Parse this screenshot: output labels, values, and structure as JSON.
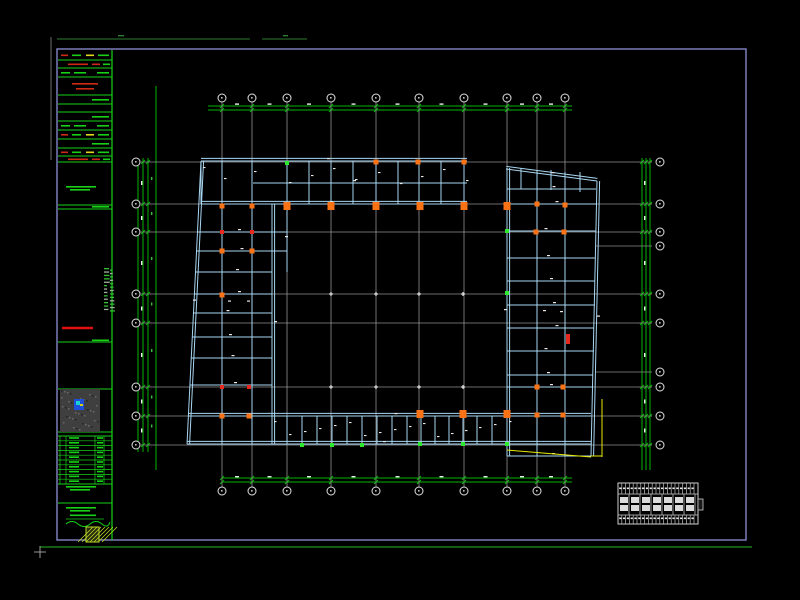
{
  "meta": {
    "app": "cad-viewer",
    "sheet_description": "structural-framing-plan-sheet",
    "canvas": {
      "w": 800,
      "h": 600
    }
  },
  "colors": {
    "bg": "#000000",
    "border_violet": "#8585c8",
    "strip_green": "#17d117",
    "dim_green": "#00b400",
    "faint_green": "#2e7d32",
    "grid_gray": "#9a9a9a",
    "bubble_stroke": "#e0e0e0",
    "beam_cyan": "#a9d7f2",
    "marker_orange": "#f97316",
    "marker_red": "#e8281e",
    "marker_green": "#2ee82e",
    "yellow": "#e8e800",
    "text_white": "#eaeaea",
    "red_text": "#cc2a14"
  },
  "frame": {
    "border": {
      "x1": 57,
      "y1": 49,
      "x2": 746,
      "y2": 540
    },
    "outer_vline": {
      "x": 51,
      "y1": 37,
      "y2": 160
    },
    "top_green_segs": [
      [
        57,
        39,
        250
      ],
      [
        262,
        39,
        307
      ]
    ],
    "top_green_dashes": [
      [
        118,
        35,
        6
      ],
      [
        283,
        35,
        5
      ]
    ],
    "bottom_green": {
      "y": 547,
      "x1": 40,
      "x2": 752
    },
    "ucs_cross": {
      "x": 40,
      "y": 552,
      "arm": 6
    }
  },
  "title_strip": {
    "x1": 58,
    "x2": 112,
    "y1": 50,
    "y2": 540,
    "dividers": [
      60,
      68,
      77,
      95,
      104,
      112,
      121,
      130,
      139,
      148,
      156,
      162,
      205,
      209,
      342,
      389,
      432,
      436,
      484,
      503,
      545
    ],
    "rows": [
      {
        "y": 51,
        "h": 9,
        "kind": "gr"
      },
      {
        "y": 61,
        "h": 7,
        "kind": "r"
      },
      {
        "y": 69,
        "h": 8,
        "kind": "g"
      },
      {
        "y": 78,
        "h": 17,
        "kind": "rb"
      },
      {
        "y": 96,
        "h": 8,
        "kind": "g2"
      },
      {
        "y": 105,
        "h": 7,
        "kind": "e"
      },
      {
        "y": 113,
        "h": 8,
        "kind": "g2"
      },
      {
        "y": 122,
        "h": 8,
        "kind": "g"
      },
      {
        "y": 131,
        "h": 8,
        "kind": "gr"
      },
      {
        "y": 140,
        "h": 8,
        "kind": "g2"
      },
      {
        "y": 149,
        "h": 7,
        "kind": "gr"
      },
      {
        "y": 157,
        "h": 5,
        "kind": "r"
      },
      {
        "y": 184,
        "h": 6,
        "kind": "gtext"
      },
      {
        "y": 205,
        "h": 4,
        "kind": "g2"
      },
      {
        "y": 338,
        "h": 5,
        "kind": "g2"
      },
      {
        "y": 484,
        "h": 6,
        "kind": "gtext"
      },
      {
        "y": 504,
        "h": 8,
        "kind": "gtext"
      },
      {
        "y": 512,
        "h": 7,
        "kind": "gu"
      },
      {
        "y": 519,
        "h": 8,
        "kind": "sig"
      }
    ],
    "red_line": {
      "x1": 62,
      "x2": 93,
      "y": 328
    },
    "map_thumb": {
      "x": 60,
      "y": 389,
      "w": 40,
      "h": 43,
      "dot": {
        "x": 74,
        "y": 399,
        "w": 10,
        "h": 11
      }
    },
    "mini_table": {
      "y1": 436,
      "y2": 484,
      "rows": 10,
      "col_xs": [
        60,
        66,
        95,
        104
      ]
    },
    "logo": {
      "x": 86,
      "y": 527,
      "w": 13,
      "h": 15
    },
    "side_text": {
      "cols": [
        {
          "x": 104,
          "w": 6
        },
        {
          "x": 110,
          "w": 5
        }
      ],
      "y1": 268,
      "y2": 312,
      "step": 3.4
    }
  },
  "grids": {
    "v_xs": [
      222,
      252,
      287,
      331,
      376,
      419,
      464,
      507,
      537,
      565
    ],
    "v_y1": 102,
    "v_y2": 487,
    "bubble_top_y": 98,
    "bubble_bot_y": 491,
    "h_ys": [
      162,
      204,
      232,
      294,
      323,
      387,
      416,
      445
    ],
    "h_x1": 141,
    "h_x2": 652,
    "bubble_left_x": 136,
    "bubble_right_x": 660,
    "h_stubs": [
      246,
      372
    ],
    "stub_x1": 596,
    "stub_x2": 652,
    "bubble_r": 4
  },
  "dims": {
    "top": {
      "ys": [
        106,
        110
      ],
      "x1": 208,
      "x2": 572
    },
    "bottom": {
      "ys": [
        478,
        482
      ],
      "x1": 222,
      "x2": 572
    },
    "left": {
      "xs": [
        138,
        143,
        148
      ],
      "y1": 158,
      "y2": 452,
      "extra_x": 156,
      "extra_y1": 86,
      "extra_y2": 470
    },
    "right": {
      "xs": [
        642,
        646,
        650
      ],
      "y1": 158,
      "y2": 470
    }
  },
  "beams": {
    "double": [
      [
        201,
        161,
        467,
        161
      ],
      [
        201,
        204,
        467,
        204
      ],
      [
        201,
        161,
        187,
        444
      ],
      [
        272,
        204,
        272,
        444
      ],
      [
        188,
        416,
        591,
        416
      ],
      [
        187,
        444,
        591,
        444
      ],
      [
        507,
        168,
        507,
        456
      ],
      [
        506,
        169,
        597,
        181
      ],
      [
        597,
        181,
        591,
        456
      ]
    ],
    "single": [
      [
        253,
        183,
        467,
        183
      ],
      [
        197,
        232,
        287,
        232
      ],
      [
        196,
        251,
        287,
        251
      ],
      [
        196,
        272,
        272,
        272
      ],
      [
        194,
        294,
        272,
        294
      ],
      [
        193,
        313,
        272,
        313
      ],
      [
        192,
        337,
        272,
        337
      ],
      [
        191,
        358,
        272,
        358
      ],
      [
        190,
        385,
        272,
        385
      ],
      [
        222,
        163,
        222,
        444
      ],
      [
        252,
        163,
        252,
        444
      ],
      [
        287,
        206,
        287,
        272
      ],
      [
        507,
        189,
        596,
        189
      ],
      [
        507,
        204,
        596,
        204
      ],
      [
        507,
        231,
        596,
        231
      ],
      [
        507,
        258,
        595,
        258
      ],
      [
        507,
        281,
        595,
        281
      ],
      [
        507,
        305,
        595,
        305
      ],
      [
        507,
        328,
        594,
        328
      ],
      [
        507,
        351,
        594,
        351
      ],
      [
        507,
        375,
        593,
        375
      ],
      [
        507,
        387,
        593,
        387
      ],
      [
        507,
        456,
        591,
        456
      ],
      [
        537,
        170,
        537,
        456
      ],
      [
        565,
        172,
        565,
        456
      ],
      [
        521,
        168,
        521,
        189
      ],
      [
        551,
        170,
        551,
        190
      ],
      [
        580,
        172,
        580,
        192
      ]
    ],
    "top_cross": {
      "xs": [
        201,
        222,
        252,
        287,
        309,
        331,
        353,
        376,
        398,
        419,
        441,
        464
      ],
      "y1": 161,
      "y2": 204
    },
    "bottom_cross": {
      "xs": [
        272,
        287,
        302,
        317,
        332,
        347,
        362,
        377,
        392,
        407,
        421,
        435,
        449,
        463,
        477,
        492,
        507
      ],
      "y1": 416,
      "y2": 444
    }
  },
  "markers": {
    "big_orange": [
      [
        287,
        206
      ],
      [
        331,
        206
      ],
      [
        376,
        206
      ],
      [
        420,
        206
      ],
      [
        464,
        206
      ],
      [
        507,
        206
      ],
      [
        420,
        414
      ],
      [
        463,
        414
      ],
      [
        507,
        414
      ]
    ],
    "small_orange": [
      [
        376,
        162
      ],
      [
        418,
        162
      ],
      [
        464,
        162
      ],
      [
        537,
        204
      ],
      [
        565,
        205
      ],
      [
        536,
        232
      ],
      [
        564,
        232
      ],
      [
        537,
        387
      ],
      [
        563,
        387
      ],
      [
        537,
        415
      ],
      [
        563,
        415
      ],
      [
        222,
        206
      ],
      [
        252,
        206
      ],
      [
        222,
        251
      ],
      [
        252,
        251
      ],
      [
        222,
        295
      ],
      [
        222,
        416
      ],
      [
        249,
        416
      ]
    ],
    "small_red": [
      [
        222,
        232
      ],
      [
        252,
        232
      ],
      [
        222,
        387
      ],
      [
        249,
        387
      ]
    ],
    "small_green": [
      [
        287,
        163
      ],
      [
        302,
        445
      ],
      [
        332,
        445
      ],
      [
        362,
        445
      ],
      [
        420,
        444
      ],
      [
        463,
        444
      ],
      [
        507,
        444
      ],
      [
        507,
        293
      ],
      [
        507,
        231
      ]
    ],
    "red_rect": [
      566,
      334,
      4,
      10
    ]
  },
  "yellow_lines": [
    [
      507,
      450,
      591,
      457
    ],
    [
      602,
      399,
      602,
      457
    ],
    [
      591,
      456,
      602,
      456
    ]
  ],
  "courtyard_marks": [
    [
      331,
      294
    ],
    [
      376,
      294
    ],
    [
      419,
      294
    ],
    [
      463,
      294
    ],
    [
      331,
      387
    ],
    [
      376,
      387
    ],
    [
      419,
      387
    ],
    [
      463,
      387
    ]
  ],
  "schedule_table": {
    "x": 618,
    "y": 483,
    "w": 80,
    "h": 41,
    "row_ys": [
      494,
      515
    ],
    "narrow_col_step": 3.8,
    "wide_col_step": 11,
    "tab": [
      698,
      499,
      5,
      11
    ]
  }
}
